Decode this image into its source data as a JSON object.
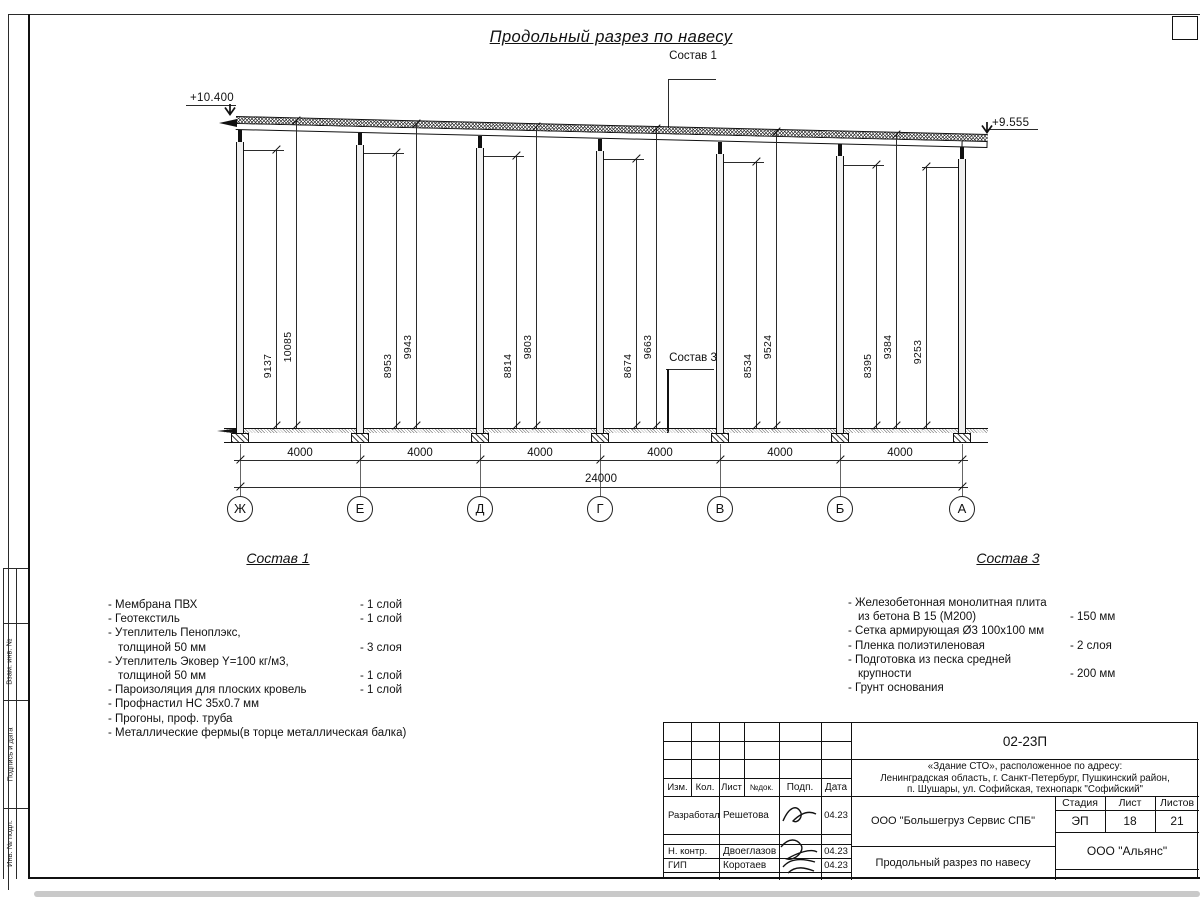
{
  "title": "Продольный разрез по навесу",
  "elevations": {
    "left": "+10.400",
    "right": "+9.555"
  },
  "leaders": {
    "sostav1": "Состав 1",
    "sostav3": "Состав 3"
  },
  "axes": [
    "Ж",
    "Е",
    "Д",
    "Г",
    "В",
    "Б",
    "А"
  ],
  "bay_dim": "4000",
  "total_dim": "24000",
  "bays": [
    {
      "a": "9137",
      "b": "10085"
    },
    {
      "a": "8953",
      "b": "9943"
    },
    {
      "a": "8814",
      "b": "9803"
    },
    {
      "a": "8674",
      "b": "9663"
    },
    {
      "a": "8534",
      "b": "9524"
    },
    {
      "a": "8395",
      "b": "9384"
    }
  ],
  "extra_dim": "9253",
  "sostav1": {
    "heading": "Состав 1",
    "items": [
      {
        "name": "- Мембрана ПВХ",
        "qty": "- 1 слой"
      },
      {
        "name": "- Геотекстиль",
        "qty": "- 1 слой"
      },
      {
        "name": "- Утеплитель Пеноплэкс,",
        "qty": ""
      },
      {
        "name": "толщиной 50 мм",
        "qty": "- 3 слоя"
      },
      {
        "name": "- Утеплитель Эковер Y=100 кг/м3,",
        "qty": ""
      },
      {
        "name": "толщиной 50 мм",
        "qty": "- 1 слой"
      },
      {
        "name": "- Пароизоляция для плоских кровель",
        "qty": "- 1 слой"
      },
      {
        "name": "- Профнастил НС 35х0.7 мм",
        "qty": ""
      },
      {
        "name": "- Прогоны, проф. труба",
        "qty": ""
      },
      {
        "name": "- Металлические фермы(в торце металлическая балка)",
        "qty": ""
      }
    ]
  },
  "sostav3": {
    "heading": "Состав 3",
    "items": [
      {
        "name": "- Железобетонная  монолитная плита",
        "qty": ""
      },
      {
        "name": "из бетона В 15 (М200)",
        "qty": "- 150 мм"
      },
      {
        "name": "- Сетка армирующая Ø3 100х100 мм",
        "qty": ""
      },
      {
        "name": "- Пленка полиэтиленовая",
        "qty": "-  2 слоя"
      },
      {
        "name": "- Подготовка из песка средней",
        "qty": ""
      },
      {
        "name": "крупности",
        "qty": "- 200 мм"
      },
      {
        "name": "- Грунт основания",
        "qty": ""
      }
    ]
  },
  "stamp": {
    "doc_number": "02-23П",
    "object_lines": [
      "«Здание СТО», расположенное по адресу:",
      "Ленинградская область, г. Санкт-Петербург, Пушкинский район,",
      "п. Шушары, ул. Софийская, технопарк \"Софийский\""
    ],
    "rev_headers": [
      "Изм.",
      "Кол.",
      "Лист",
      "№док.",
      "Подп.",
      "Дата"
    ],
    "people": [
      {
        "role": "Разработал",
        "name": "Решетова",
        "date": "04.23"
      },
      {
        "role": "Н. контр.",
        "name": "Двоеглазов",
        "date": "04.23"
      },
      {
        "role": "ГИП",
        "name": "Коротаев",
        "date": "04.23"
      }
    ],
    "company": "ООО \"Большегруз Сервис СПБ\"",
    "stage_label": "Стадия",
    "sheet_label": "Лист",
    "sheets_label": "Листов",
    "stage": "ЭП",
    "sheet": "18",
    "sheets": "21",
    "drawing_name": "Продольный разрез по навесу",
    "org": "ООО \"Альянс\""
  },
  "margin_labels": [
    "Взам. инв. №",
    "Подпись и дата",
    "Инв. № подл."
  ]
}
